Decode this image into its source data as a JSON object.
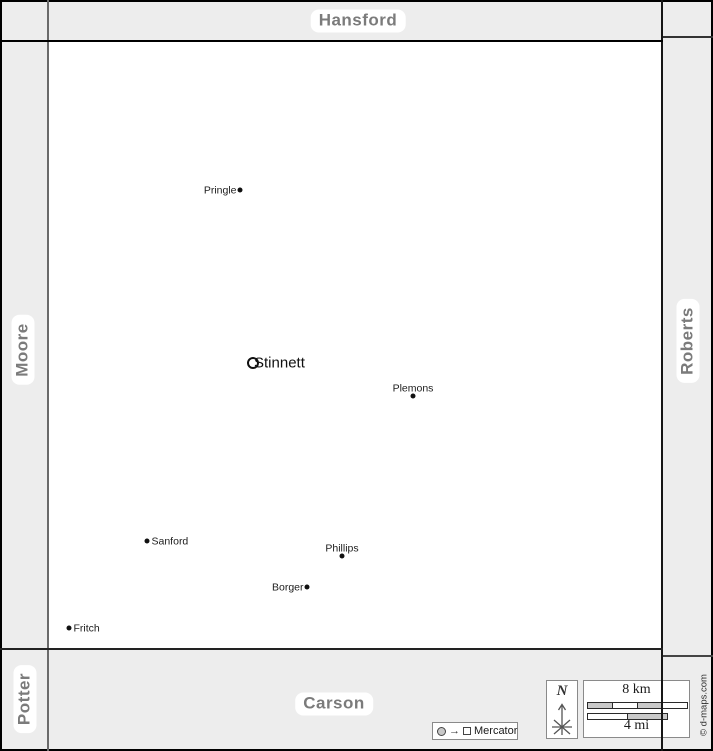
{
  "neighbors": {
    "top": {
      "label": "Hansford"
    },
    "left": {
      "label": "Moore"
    },
    "right": {
      "label": "Roberts"
    },
    "bottom": {
      "label": "Carson"
    },
    "bottom_left": {
      "label": "Potter"
    }
  },
  "towns": [
    {
      "name": "Pringle",
      "x": 240,
      "y": 190,
      "marker": "dot",
      "label_side": "left",
      "size": "small"
    },
    {
      "name": "Stinnett",
      "x": 253,
      "y": 363,
      "marker": "ring",
      "label_side": "right",
      "size": "large"
    },
    {
      "name": "Plemons",
      "x": 413,
      "y": 396,
      "marker": "dot",
      "label_side": "top",
      "size": "small"
    },
    {
      "name": "Sanford",
      "x": 147,
      "y": 541,
      "marker": "dot",
      "label_side": "right",
      "size": "small"
    },
    {
      "name": "Phillips",
      "x": 342,
      "y": 556,
      "marker": "dot",
      "label_side": "top",
      "size": "small"
    },
    {
      "name": "Borger",
      "x": 307,
      "y": 587,
      "marker": "dot",
      "label_side": "left",
      "size": "small"
    },
    {
      "name": "Fritch",
      "x": 69,
      "y": 628,
      "marker": "dot",
      "label_side": "right",
      "size": "small"
    }
  ],
  "compass": {
    "north_label": "N"
  },
  "scale_bar": {
    "km_label": "8 km",
    "mi_label": "4 mi",
    "km_segments": [
      "#c9c9c9",
      "#ffffff",
      "#c9c9c9",
      "#ffffff"
    ],
    "mi_segments": [
      "#ffffff",
      "#c9c9c9"
    ]
  },
  "projection_legend": {
    "label": "Mercator"
  },
  "credit": {
    "label": "© d-maps.com"
  },
  "colors": {
    "band_background": "#ededed",
    "map_background": "#ffffff",
    "neighbor_label_text": "#7b7b7b",
    "label_pill_background": "#ffffff",
    "boundary_line": "#000000",
    "town_marker": "#111111",
    "scale_segment_gray": "#c9c9c9"
  }
}
